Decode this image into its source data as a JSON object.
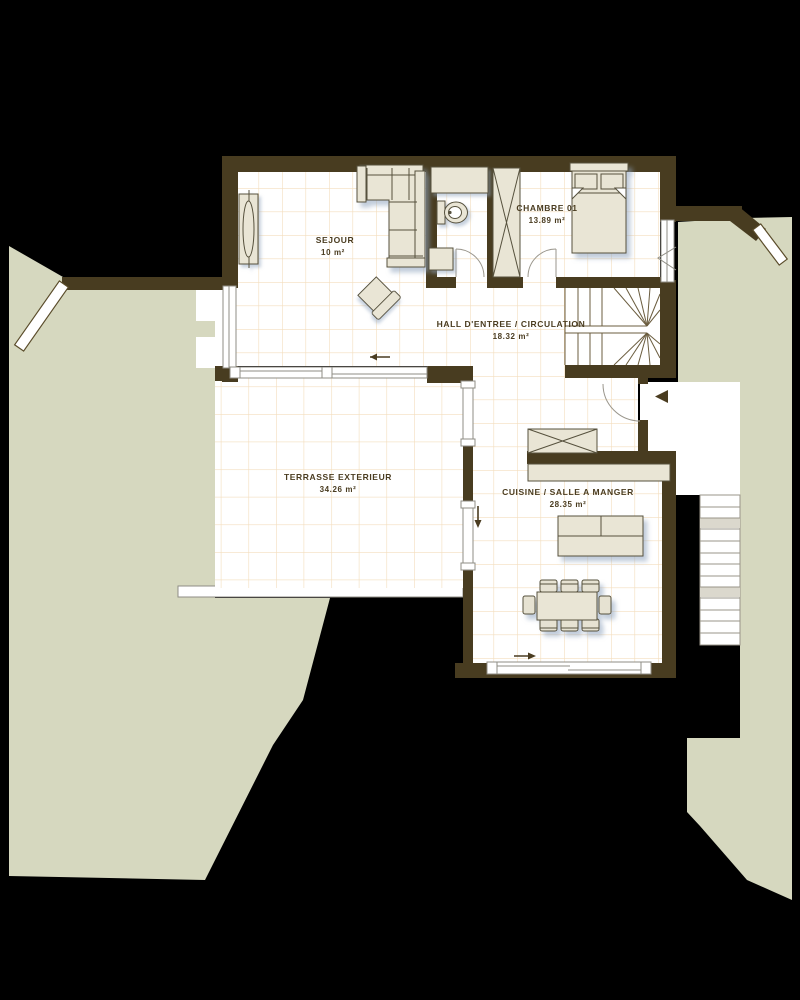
{
  "plan": {
    "rooms": [
      {
        "id": "sejour",
        "label": "SEJOUR",
        "area": "10 m²"
      },
      {
        "id": "chambre",
        "label": "CHAMBRE 01",
        "area": "13.89 m²"
      },
      {
        "id": "hall",
        "label": "HALL D'ENTREE / CIRCULATION",
        "area": "18.32 m²"
      },
      {
        "id": "terrasse",
        "label": "TERRASSE EXTERIEUR",
        "area": "34.26 m²"
      },
      {
        "id": "cuisine",
        "label": "CUISINE / SALLE A MANGER",
        "area": "28.35 m²"
      }
    ],
    "colors": {
      "background": "#000000",
      "terrain": "#d6d8bf",
      "wall": "#483c20",
      "floor": "#ffffff",
      "tile_line": "#f3ddbd",
      "furniture": "#e9e5d5",
      "label": "#4a3c20",
      "shadow": "#8fa3bd"
    }
  }
}
